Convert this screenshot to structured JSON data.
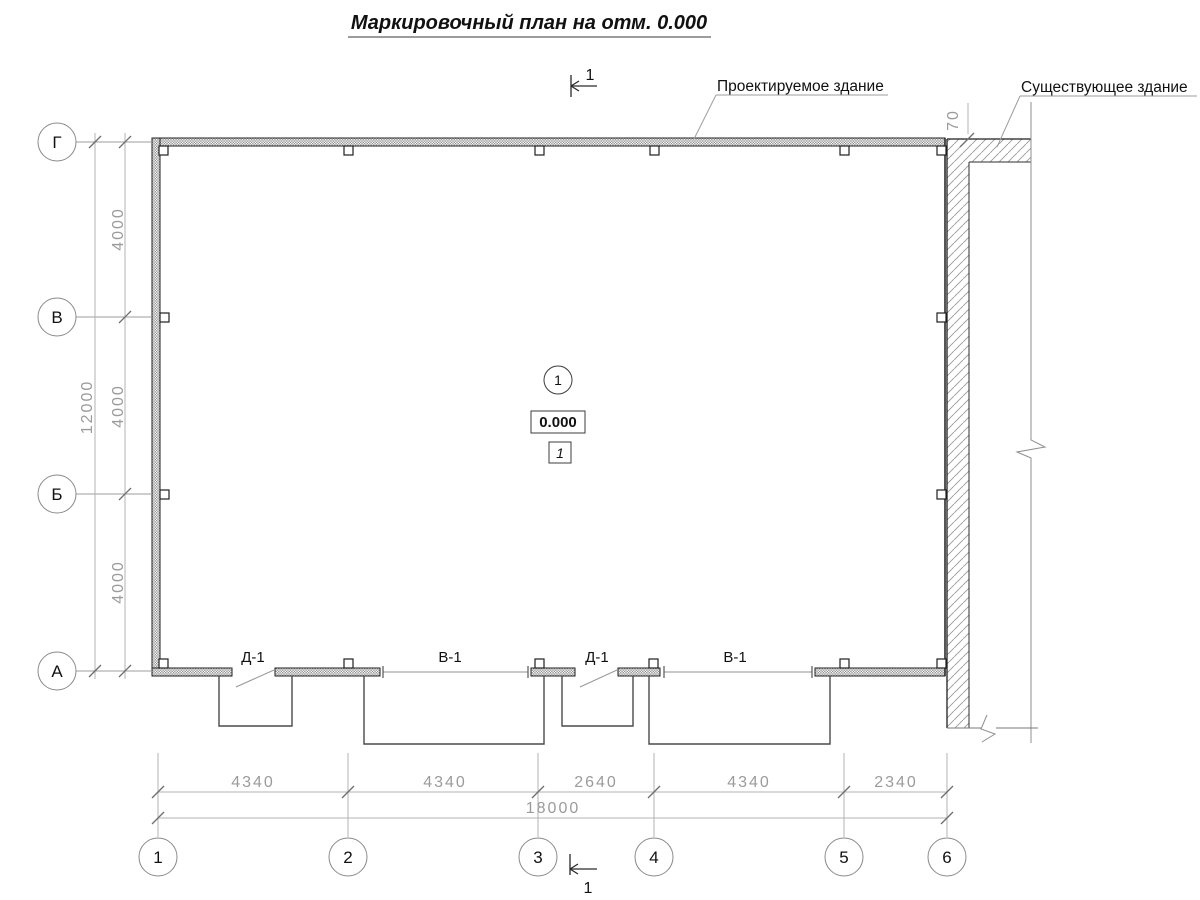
{
  "title": "Маркировочный план на отм. 0.000",
  "labels": {
    "designed": "Проектируемое здание",
    "existing": "Существующее здание"
  },
  "section": {
    "top": "1",
    "bottom": "1"
  },
  "grid": {
    "rows": [
      "Г",
      "В",
      "Б",
      "А"
    ],
    "cols": [
      "1",
      "2",
      "3",
      "4",
      "5",
      "6"
    ]
  },
  "dims": {
    "left_total": "12000",
    "left_segments": [
      "4000",
      "4000",
      "4000"
    ],
    "bottom_segments": [
      "4340",
      "4340",
      "2640",
      "4340",
      "2340"
    ],
    "bottom_total": "18000",
    "gap": "70"
  },
  "openings": [
    "Д-1",
    "В-1",
    "Д-1",
    "В-1"
  ],
  "interior": {
    "node": "1",
    "elevation": "0.000",
    "room": "1"
  },
  "colors": {
    "line": "#1f1f1f",
    "dim_text": "#9b9b9b",
    "wall_hatch": "#8d8d8d",
    "existing_hatch": "#9a9a9a"
  }
}
